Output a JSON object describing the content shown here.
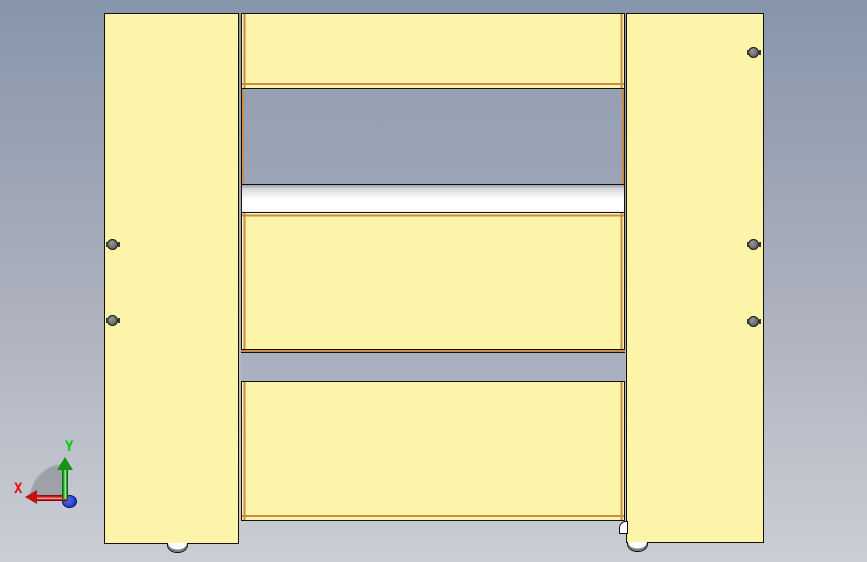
{
  "colors": {
    "bg_top": "#8795ab",
    "bg_mid": "#a9aebb",
    "bg_bottom": "#cbced5",
    "panel_yellow": "#fcf4a9",
    "edge_tan": "#c98b45",
    "outline_ink": "#17100a",
    "opening_top": "#95a0b2",
    "opening_bottom": "#9aa4b4",
    "gap_gray": "#a9b0bf",
    "roller_white": "#ffffff",
    "bolt_gray": "#6a6a6a",
    "axis_x_red": "#e31212",
    "axis_y_green": "#00cf00",
    "axis_z_blue": "#2743d0",
    "arc_gray": "rgba(125,131,141,0.55)"
  },
  "axis_triad": {
    "x_label": "X",
    "y_label": "Y"
  }
}
